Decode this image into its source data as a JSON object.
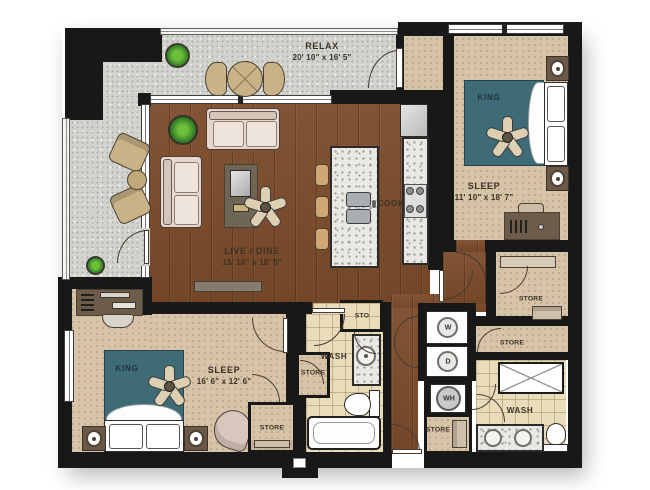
{
  "plan_title": "Two bedroom two bath floor plan",
  "colors": {
    "wall": "#181818",
    "wood_floor": "#7c4b2a",
    "carpet": "#d7c3a8",
    "balcony_concrete": "#d3d3cd",
    "bath_tile": "#e9dcba",
    "counter_granite": "#eae8e4",
    "bed": "#3e6b76",
    "sofa": "#e5d7cd",
    "plant_green": "#55a13a"
  },
  "rooms": {
    "relax": {
      "label": "RELAX",
      "dims": "20' 10\" x 16' 5\""
    },
    "sleep_1": {
      "label": "SLEEP",
      "dims": "11' 10\" x 18' 7\"",
      "bed_label": "KING"
    },
    "live_dine": {
      "label": "LIVE / DINE",
      "dims": "15' 10\" x 18' 5\""
    },
    "cook": {
      "label": "COOK"
    },
    "sleep_2": {
      "label": "SLEEP",
      "dims": "16' 6\" x 12' 6\"",
      "bed_label": "KING"
    },
    "wash_1": {
      "label": "WASH"
    },
    "wash_2": {
      "label": "WASH"
    },
    "sto": {
      "label": "STO"
    },
    "store_hall": {
      "label": "STORE"
    },
    "store_linen": {
      "label": "STORE"
    },
    "store_bedroom_2_wall": {
      "label": "STORE"
    },
    "store_bedroom_2": {
      "label": "STORE"
    },
    "store_entry": {
      "label": "STORE"
    }
  },
  "appliances": {
    "washer": "W",
    "dryer": "D",
    "water_heater": "WH"
  }
}
